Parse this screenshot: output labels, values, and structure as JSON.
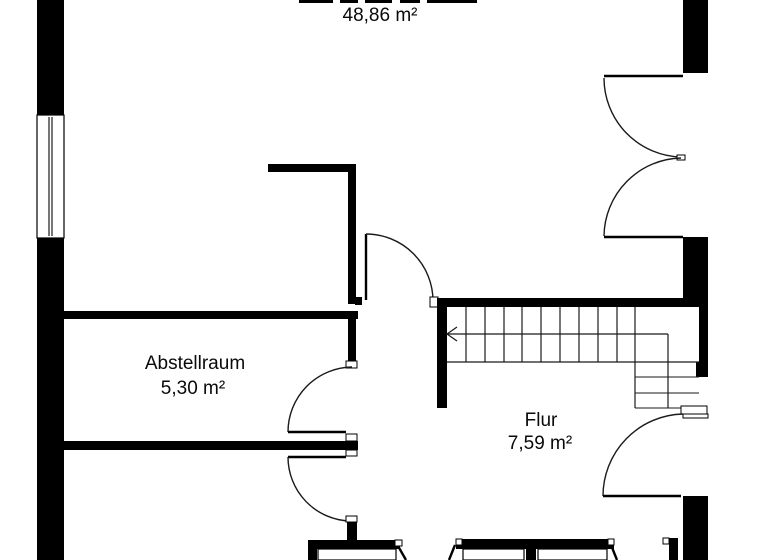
{
  "page": {
    "type": "floor-plan",
    "background": "#ffffff"
  },
  "colors": {
    "wall": "#000000",
    "text": "#0a0a0a"
  },
  "rooms": {
    "main": {
      "area": "48,86 m²"
    },
    "abstellraum": {
      "name": "Abstellraum",
      "area": "5,30 m²"
    },
    "flur": {
      "name": "Flur",
      "area": "7,59 m²"
    }
  },
  "stairs": {
    "tread_count": 10,
    "walk_arrow_direction": "left"
  }
}
